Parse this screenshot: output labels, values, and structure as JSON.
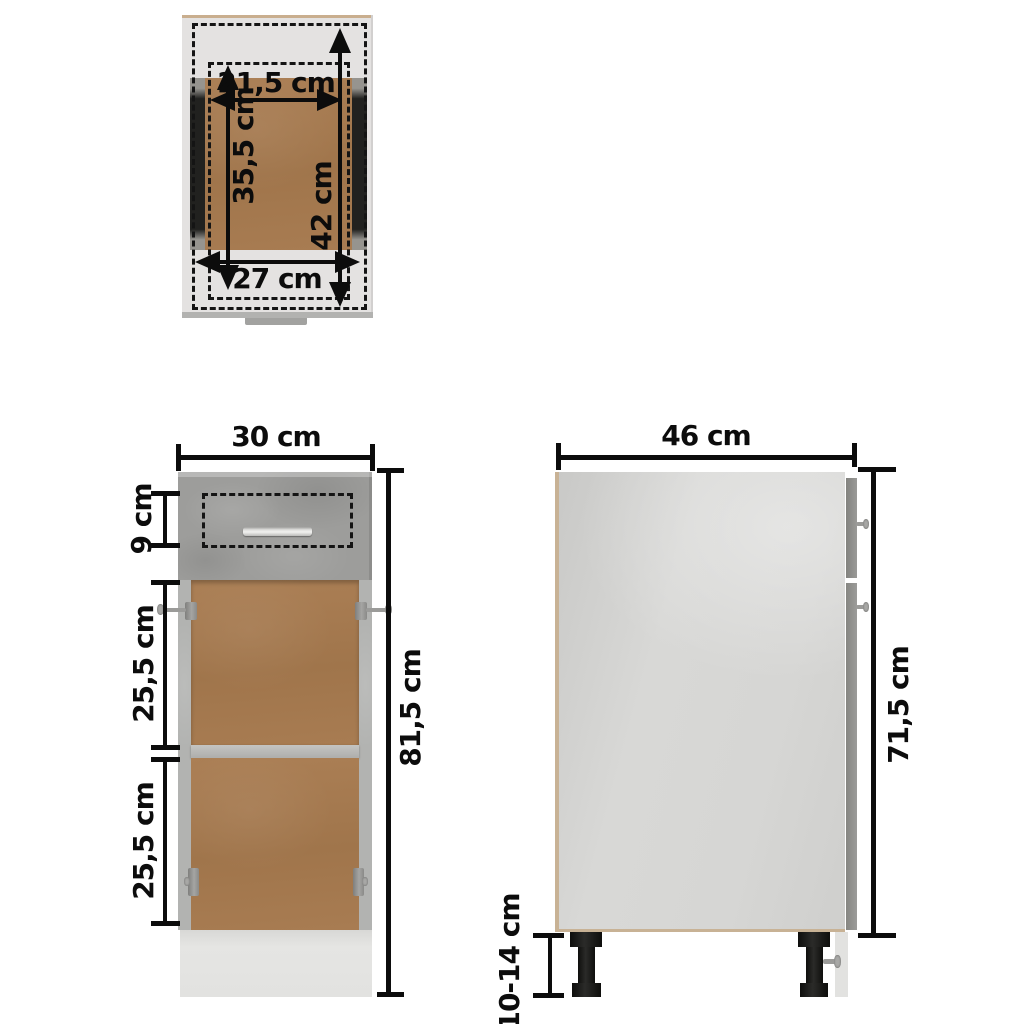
{
  "diagram": {
    "type": "furniture-dimension-diagram",
    "subject": "base cabinet with drawer and open shelf compartment",
    "unit": "cm"
  },
  "colors": {
    "background": "#ffffff",
    "dimension_ink": "#0c0c0c",
    "concrete_grey_front": "#9d9d9b",
    "carcass_light_grey": "#e4e2e1",
    "side_panel_grey": "#d5d5d3",
    "interior_wood_brown": "#a87c52",
    "edge_tan": "#c9ae8e",
    "drawer_slide_black": "#1e1e1c",
    "leg_black": "#1a1a18",
    "handle_silver": "#dddddb"
  },
  "views": {
    "top": {
      "label": "top view - drawer interior",
      "dims": {
        "drawer_inner_width": "21,5 cm",
        "drawer_inner_depth": "35,5 cm",
        "slide_depth": "42 cm",
        "drawer_front_width": "27 cm"
      }
    },
    "front": {
      "label": "front view",
      "dims": {
        "overall_width": "30 cm",
        "drawer_front_height": "9 cm",
        "upper_compartment_height": "25,5 cm",
        "lower_compartment_height": "25,5 cm",
        "overall_height": "81,5 cm"
      }
    },
    "side": {
      "label": "side view",
      "dims": {
        "overall_depth": "46 cm",
        "carcass_height": "71,5 cm",
        "leg_height_range": "10-14 cm"
      }
    }
  }
}
